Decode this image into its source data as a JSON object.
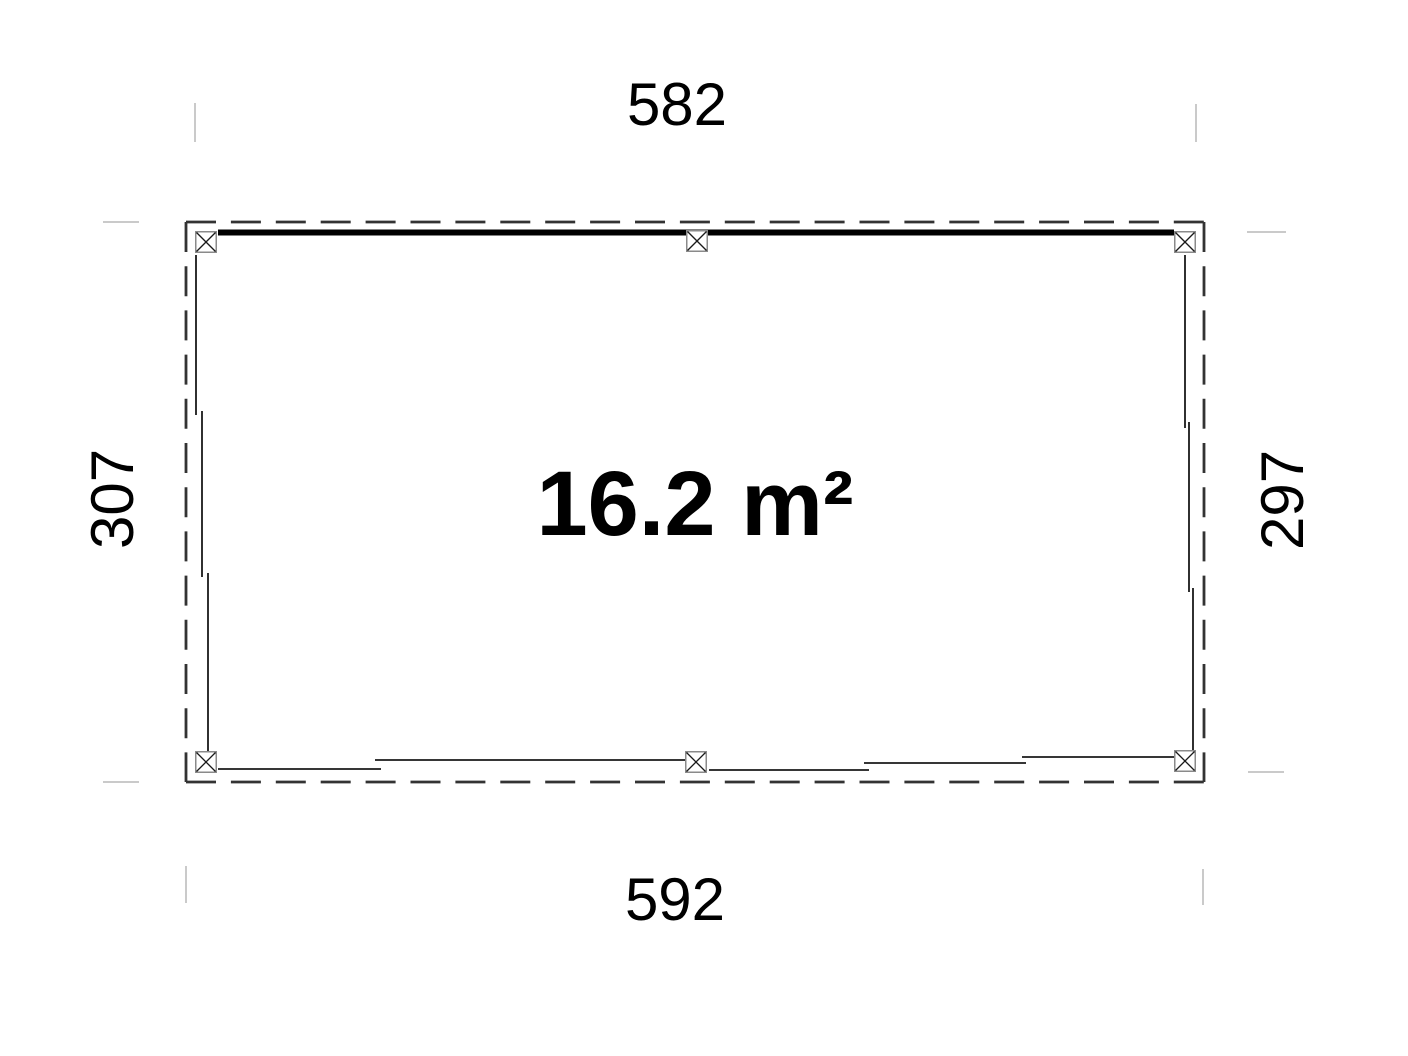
{
  "floor_plan": {
    "area_label": "16.2 m²",
    "dimension_top": "582",
    "dimension_bottom": "592",
    "dimension_left": "307",
    "dimension_right": "297"
  },
  "colors": {
    "background": "#ffffff",
    "text": "#000000",
    "beam": "#000000",
    "wall_line": "#1a1a1a",
    "dashed_outline": "#333333",
    "post_border": "#8a8a8a",
    "post_cross": "#1a1a1a",
    "witness_line": "#b9b9b9"
  }
}
